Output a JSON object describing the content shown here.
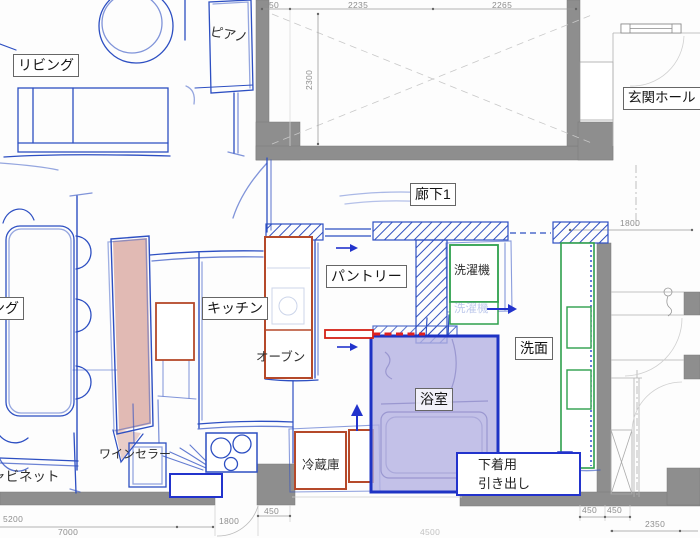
{
  "labels": {
    "living": "リビング",
    "piano": "ピアノ",
    "entrance_hall": "玄関ホール",
    "corridor1": "廊下1",
    "pantry": "パントリー",
    "kitchen": "キッチン",
    "oven": "オーブン",
    "washing_machine": "洗濯機",
    "washing_machine_ghost": "洗濯機",
    "washroom": "洗面",
    "bathroom": "浴室",
    "refrigerator": "冷蔵庫",
    "wine_cellar": "ワインセラー",
    "cabinet_clipped": "ャビネット",
    "dining_clipped": "ング",
    "underwear_drawer_line1": "下着用",
    "underwear_drawer_line2": "引き出し"
  },
  "dimensions": {
    "top_left_offset": "450",
    "top_span_left": "2235",
    "top_span_right": "2265",
    "upper_room_depth": "2300",
    "washroom_width": "1800",
    "left_total": "5200",
    "bottom_total": "7000",
    "kitchen_opening": "1800",
    "kitchen_offset": "450",
    "bottom_right_450a": "450",
    "bottom_right_450b": "450",
    "bottom_right_span": "2350",
    "bottom_center_span": "4500"
  },
  "colors": {
    "wall_gray": "#8e8e8e",
    "sketch_blue": "#2d4fc2",
    "bath_fill": "#b4b2e2",
    "bath_border": "#1e33c4",
    "island_pink": "#d8a79f",
    "cabinet_red": "#b5492a",
    "appliance_green": "#2ea04c",
    "highlight_red": "#e02020"
  }
}
